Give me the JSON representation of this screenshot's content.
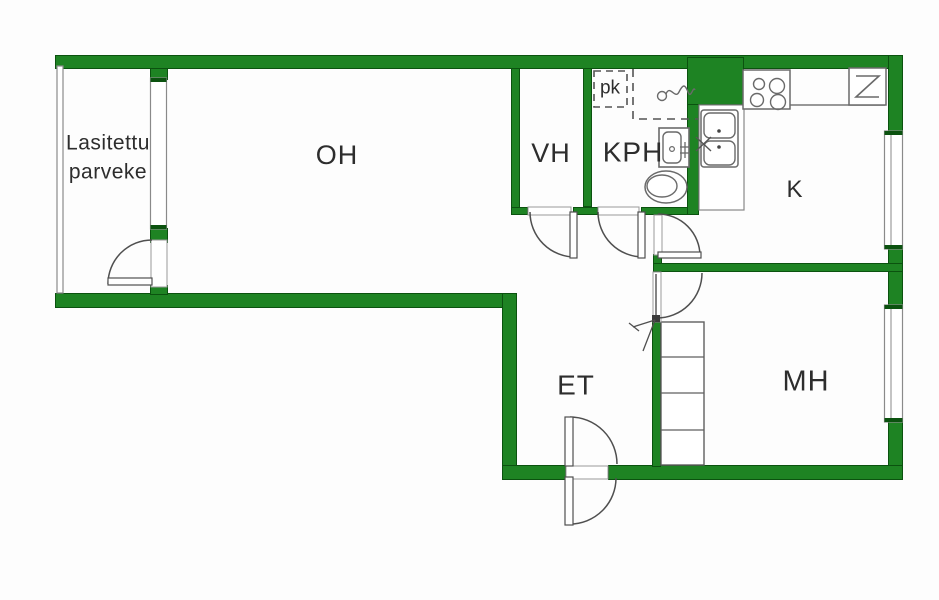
{
  "title": "Apartment floor plan",
  "colors": {
    "wall_green": "#1e8323",
    "wall_edge_green": "#0b520f",
    "fixture_line_gray": "#6a6a6a",
    "door_line_gray": "#4f4f4f",
    "label_text": "#2d2d2d",
    "background": "#fdfdfd"
  },
  "rooms": {
    "balcony": {
      "label": "Lasitettu\nparveke"
    },
    "living_room": {
      "label": "OH"
    },
    "closet": {
      "label": "VH"
    },
    "bathroom": {
      "label": "KPH"
    },
    "washer_spot": {
      "label": "pk"
    },
    "kitchen": {
      "label": "K"
    },
    "hallway": {
      "label": "ET"
    },
    "bedroom": {
      "label": "MH"
    }
  },
  "fixtures": [
    "balcony-window",
    "kitchen-window",
    "bedroom-window",
    "balcony-door",
    "closet-door",
    "bathroom-door",
    "kitchen-door",
    "bedroom-door",
    "entry-door",
    "washing-machine-space",
    "shower-mixer-icon",
    "washbasin-icon",
    "toilet-icon",
    "kitchen-sink-icon",
    "stove-icon",
    "refrigerator-icon",
    "kitchen-counter",
    "wardrobe",
    "ventilation-duct"
  ]
}
